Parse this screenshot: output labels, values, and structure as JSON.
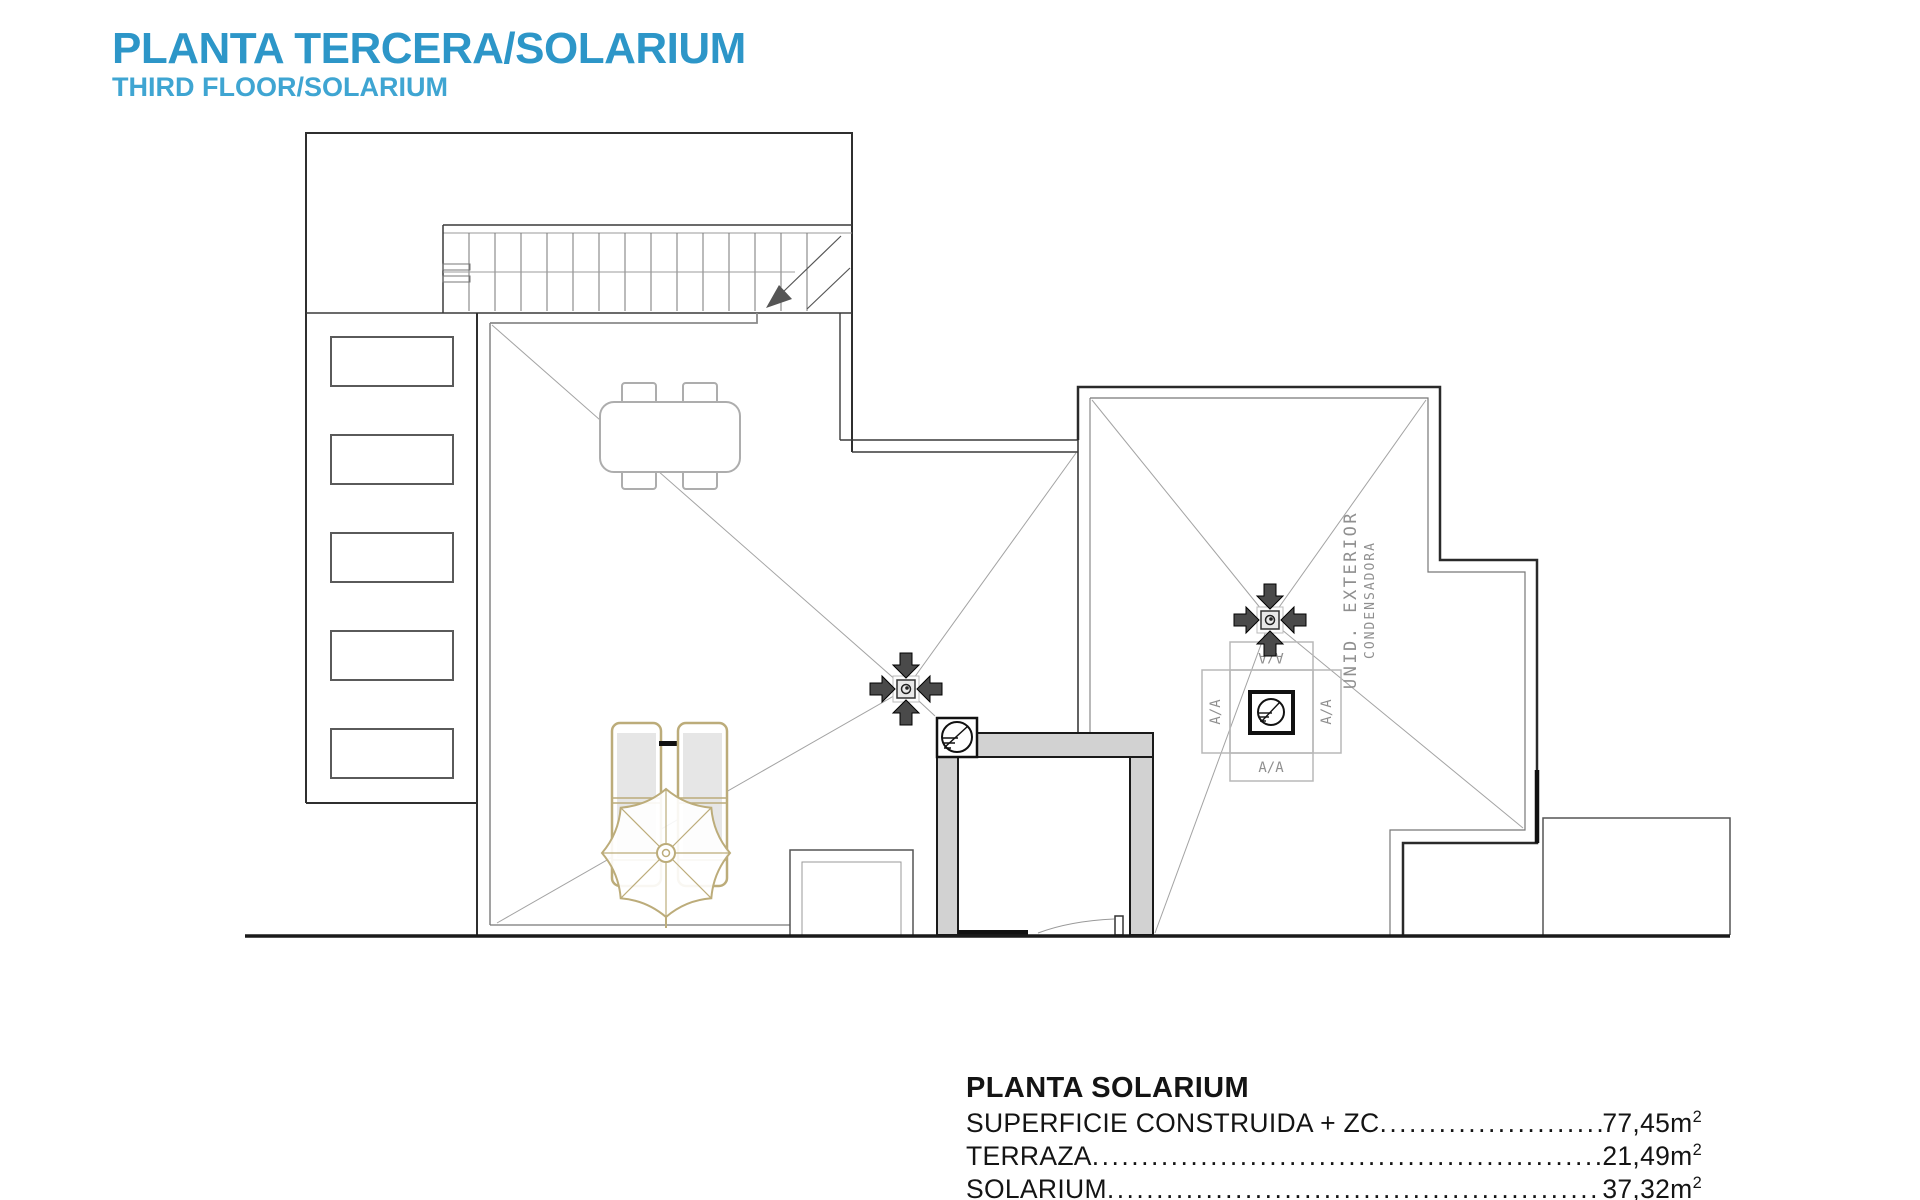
{
  "header": {
    "title": "PLANTA TERCERA/SOLARIUM",
    "subtitle": "THIRD FLOOR/SOLARIUM"
  },
  "plan": {
    "ac_unit": {
      "flap_label": "A/A",
      "label_line1": "UNID. EXTERIOR",
      "label_line2": "CONDENSADORA"
    }
  },
  "area_table": {
    "title": "PLANTA SOLARIUM",
    "rows": [
      {
        "label": "SUPERFICIE CONSTRUIDA + ZC",
        "leader": "...................................................",
        "value": "77,45m",
        "sup": "2"
      },
      {
        "label": "TERRAZA",
        "leader": "...........................................................................................",
        "value": "21,49m",
        "sup": "2"
      },
      {
        "label": "SOLARIUM",
        "leader": "...........................................................................................",
        "value": "37,32m",
        "sup": "2"
      }
    ]
  },
  "colors": {
    "title_blue": "#2D96C8",
    "subtitle_blue": "#3FA5D2",
    "wall_dark": "#2F2F2F",
    "core_wall_fill": "#D2D2D2",
    "slope_line": "#A3A3A3",
    "furniture_beige": "#BCAC7A",
    "furniture_gray": "#ADADAD",
    "cad_text_gray": "#8F8F8F"
  }
}
